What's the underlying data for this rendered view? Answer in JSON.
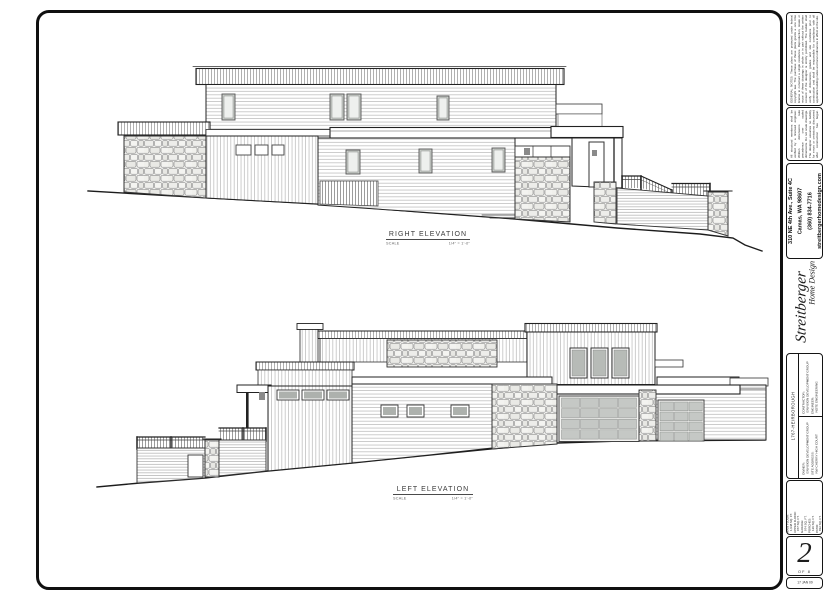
{
  "drawings": {
    "right_elevation": {
      "title": "RIGHT ELEVATION",
      "scale_label": "SCALE",
      "scale_value": "1/4\" = 1'-0\""
    },
    "left_elevation": {
      "title": "LEFT ELEVATION",
      "scale_label": "SCALE",
      "scale_value": "1/4\" = 1'-0\""
    }
  },
  "title_block": {
    "disclaimer_1": "GENERAL NOTES: These plans are protected under federal copyright law. The purchase of these plans grants a one time license to construct a single residence. Reproduction, resale or reuse of these drawings in whole or in part without the written consent of the designer is strictly prohibited. The builder shall verify all dimensions, grades and site conditions prior to construction and shall be responsible for compliance with all applicable building codes and local ordinances in effect at the site.",
    "disclaimer_2": "All structural members shall be verified by a licensed engineer. Written dimensions take precedence over scaled dimensions. Do not scale drawings. The designer assumes no liability for errors or omissions discovered after construction has begun. Report any discrepancies to the designer immediately.",
    "address": {
      "line1": "310 NE 4th Ave., Suite 4C",
      "line2": "Camas, WA 98607",
      "phone": "(360) 834-7716",
      "web": "streitbergerhomedesign.com"
    },
    "logo": {
      "name": "Streitberger",
      "tagline": "Home Design"
    },
    "project_id": "1767-HEIRBOROUGH",
    "info": {
      "contractor_label": "CONTRACTOR:",
      "contractor": "ENVISION DEVELOPMENT GROUP",
      "engineer_label": "ENGINEER:",
      "engineer": "NOTE ENGINEERING",
      "owner_label": "OWNER:",
      "owner": "ENVISION DEVELOPMENT GROUP",
      "site_label": "SITE ADDRESS:",
      "site": "NW CHERRY HIGH COURT"
    },
    "areas": [
      {
        "label": "MAIN FLOOR:",
        "value": "1,948 SQ. FT."
      },
      {
        "label": "UPPER FLOOR:",
        "value": "977 SQ. FT."
      },
      {
        "label": "GARAGE:",
        "value": "974 SQ. FT."
      },
      {
        "label": "PORCHES:",
        "value": "129 SQ. FT."
      },
      {
        "label": "PATIO:",
        "value": "832 SQ. FT."
      }
    ],
    "sheet": {
      "number": "2",
      "of_label": "OF",
      "total": "8",
      "date": "17 JAN 09"
    }
  },
  "colors": {
    "line": "#1c1c1c",
    "stone_fill": "#f1f1ef",
    "glass": "#b7bbb7",
    "garage_panel": "#c5c8c5"
  }
}
